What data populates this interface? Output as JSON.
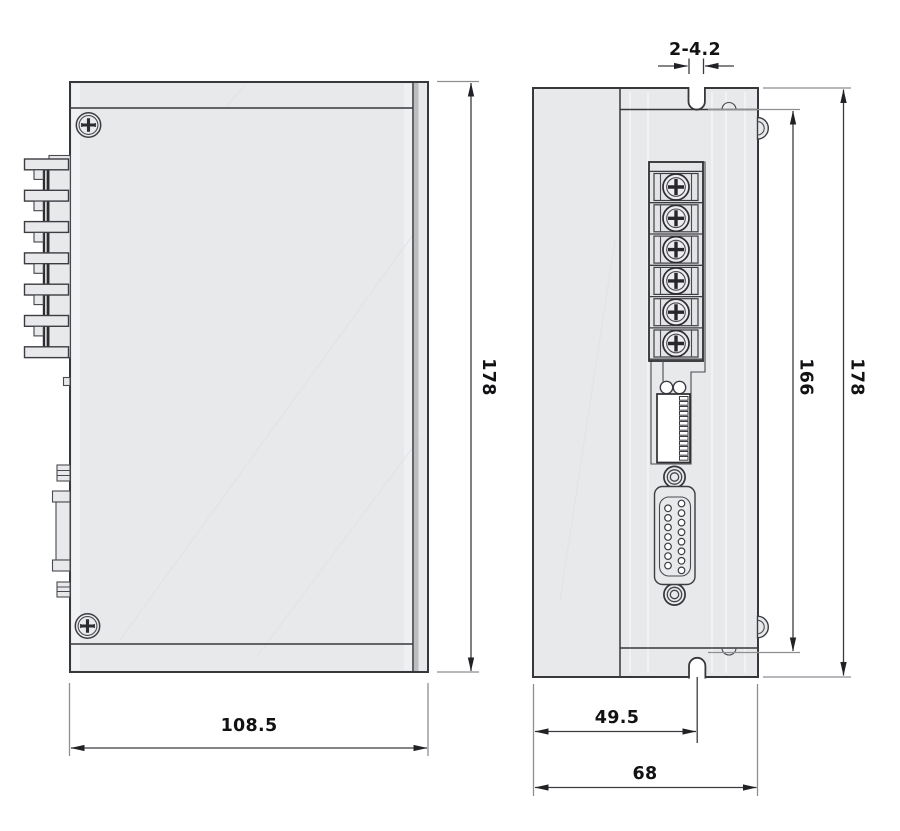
{
  "labels": {
    "side_width": "108.5",
    "side_height": "178",
    "slot_dim": "2-4.2",
    "mount_spacing": "166",
    "front_height": "178",
    "slot_offset": "49.5",
    "front_width": "68"
  },
  "colors": {
    "background": "#ffffff",
    "body_fill": "#e8e9eb",
    "outline": "#38383c",
    "extension_line": "#8e8e93",
    "dimension_text": "#121214"
  },
  "icons": {
    "case_screw": "phillips-screw-icon",
    "terminal_screw": "phillips-terminal-screw-icon",
    "db15": "db15-connector-icon",
    "dip_switch": "dip-switch-icon"
  }
}
